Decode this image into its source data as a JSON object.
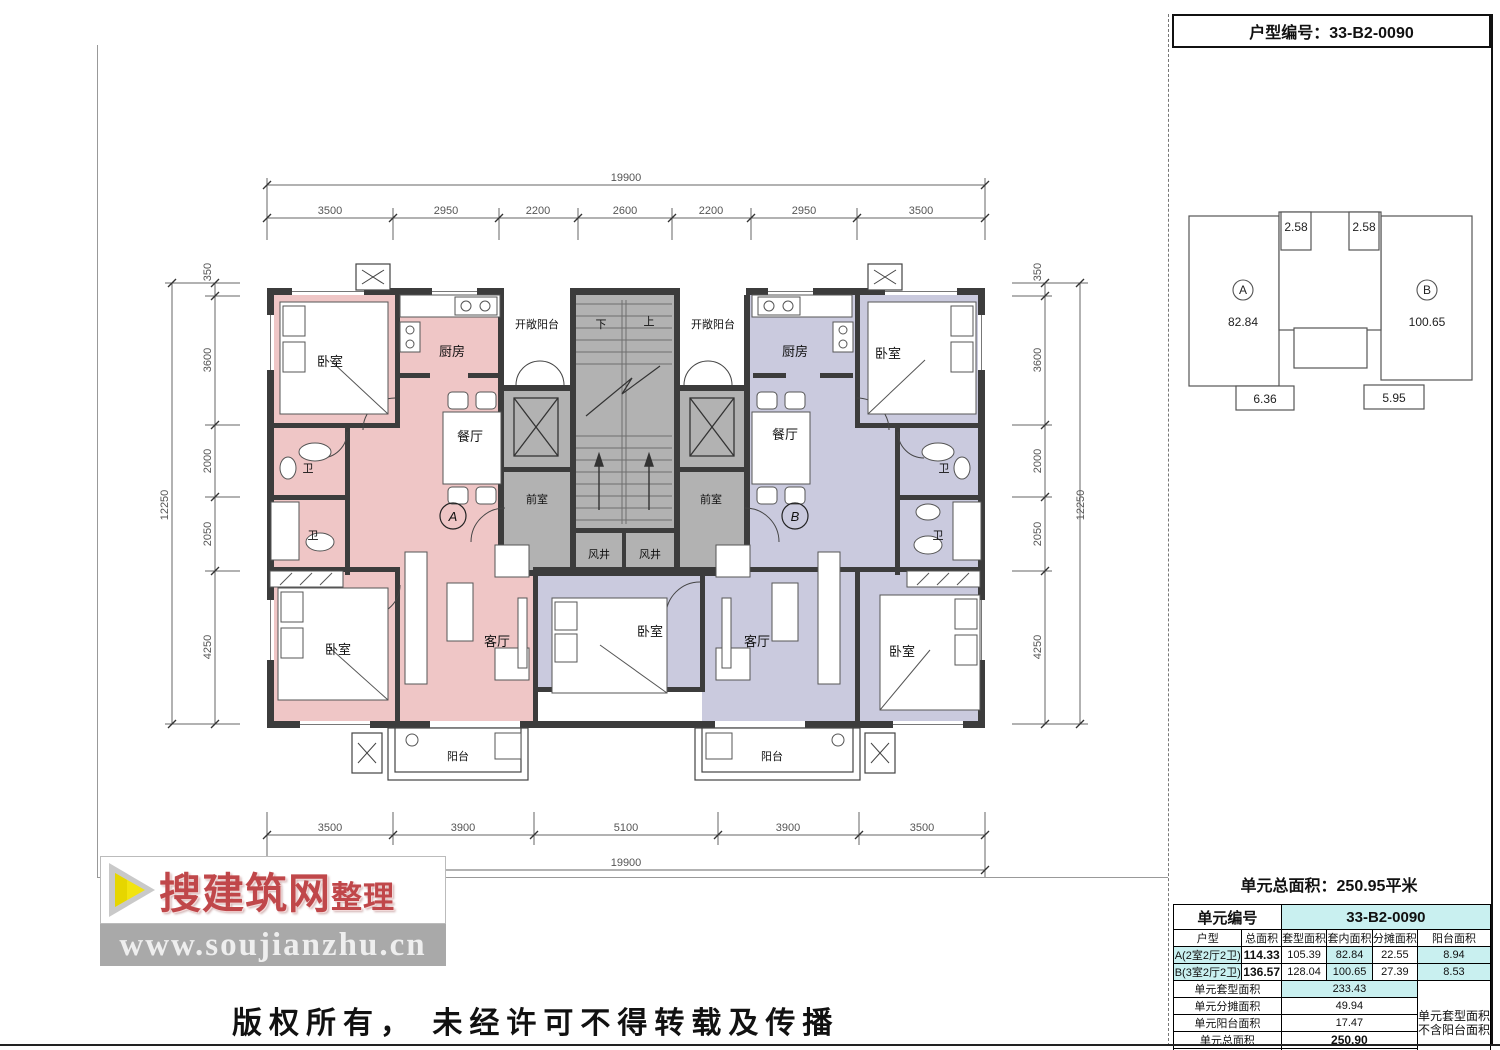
{
  "header": {
    "title": "户型编号：33-B2-0090"
  },
  "key_diagram": {
    "a_label": "A",
    "a_area": "82.84",
    "b_label": "B",
    "b_area": "100.65",
    "top_left": "2.58",
    "top_right": "2.58",
    "bottom_left": "6.36",
    "bottom_right": "5.95"
  },
  "summary": {
    "text": "单元总面积：250.95平米"
  },
  "table": {
    "unit_no_label": "单元编号",
    "unit_no_value": "33-B2-0090",
    "columns": [
      "户型",
      "总面积",
      "套型面积",
      "套内面积",
      "分摊面积",
      "阳台面积"
    ],
    "row_a": [
      "A(2室2厅2卫)",
      "114.33",
      "105.39",
      "82.84",
      "22.55",
      "8.94"
    ],
    "row_b": [
      "B(3室2厅2卫)",
      "136.57",
      "128.04",
      "100.65",
      "27.39",
      "8.53"
    ],
    "summary_rows": [
      [
        "单元套型面积",
        "233.43"
      ],
      [
        "单元分摊面积",
        "49.94"
      ],
      [
        "单元阳台面积",
        "17.47"
      ],
      [
        "单元总面积",
        "250.90"
      ],
      [
        "单元K值",
        "0.79"
      ]
    ],
    "note_line1": "单元套型面积",
    "note_line2": "不含阳台面积"
  },
  "dims": {
    "top_total": "19900",
    "top_segments": [
      "3500",
      "2950",
      "2200",
      "2600",
      "2200",
      "2950",
      "3500"
    ],
    "bottom_segments": [
      "3500",
      "3900",
      "5100",
      "3900",
      "3500"
    ],
    "bottom_total": "19900",
    "left_total": "12250",
    "left_segments": [
      "350",
      "3600",
      "2000",
      "2050",
      "4250"
    ],
    "right_total": "12250",
    "right_segments": [
      "350",
      "3600",
      "2000",
      "2050",
      "4250"
    ]
  },
  "rooms": {
    "a_bed1": "卧室",
    "a_kitchen": "厨房",
    "a_dining": "餐厅",
    "a_bath1": "卫",
    "a_bath2": "卫",
    "a_bed2": "卧室",
    "a_living": "客厅",
    "a_balcony": "阳台",
    "a_mark": "A",
    "open_balcony_left": "开敞阳台",
    "open_balcony_right": "开敞阳台",
    "stair_down": "下",
    "stair_up": "上",
    "front_room_left": "前室",
    "front_room_right": "前室",
    "shaft_left": "风井",
    "shaft_right": "风井",
    "b_kitchen": "厨房",
    "b_bed1": "卧室",
    "b_dining": "餐厅",
    "b_bath1": "卫",
    "b_bath2": "卫",
    "b_bed_mid": "卧室",
    "b_living": "客厅",
    "b_bed2": "卧室",
    "b_balcony": "阳台",
    "b_mark": "B"
  },
  "watermark": {
    "brand": "搜建筑网",
    "brand_suffix": "整理",
    "url": "www.soujianzhu.cn"
  },
  "footer": {
    "copyright": "版权所有， 未经许可不得转载及传播"
  },
  "colors": {
    "unit_a": "#efc6c6",
    "unit_b": "#cacade",
    "core": "#b2b2b2",
    "wall": "#3c3c3c",
    "accent_cyan": "#c9f0f0"
  }
}
